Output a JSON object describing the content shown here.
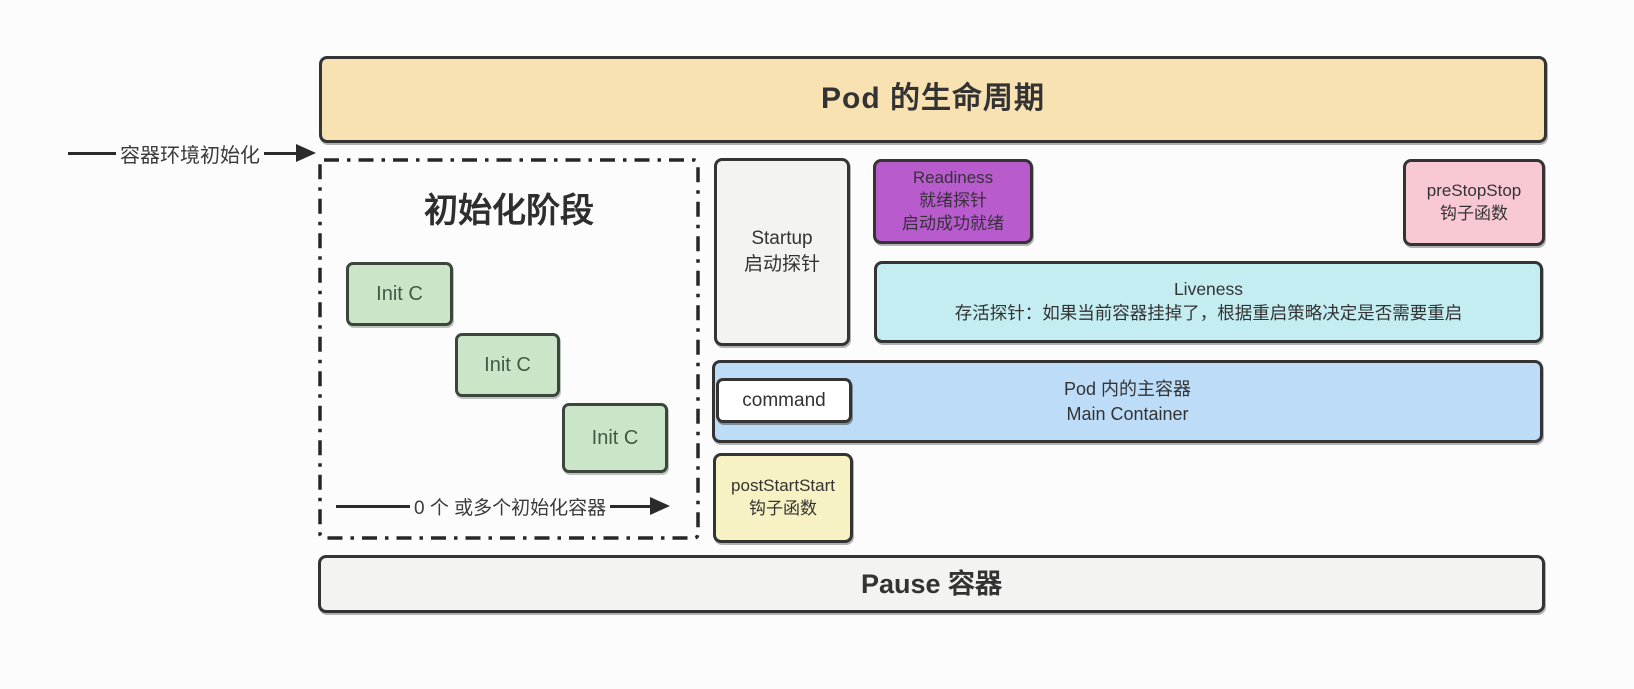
{
  "diagram": {
    "title": "Pod 的生命周期",
    "env_init_arrow_label": "容器环境初始化",
    "init_phase": {
      "title": "初始化阶段",
      "init_containers": [
        {
          "label": "Init C"
        },
        {
          "label": "Init C"
        },
        {
          "label": "Init C"
        }
      ],
      "arrow_label": "0 个 或多个初始化容器"
    },
    "startup_probe": {
      "line1": "Startup",
      "line2": "启动探针"
    },
    "readiness_probe": {
      "line1": "Readiness",
      "line2": "就绪探针",
      "line3": "启动成功就绪"
    },
    "pre_stop_hook": {
      "line1": "preStopStop",
      "line2": "钩子函数"
    },
    "liveness_probe": {
      "line1": "Liveness",
      "line2": "存活探针：如果当前容器挂掉了，根据重启策略决定是否需要重启"
    },
    "command_label": "command",
    "main_container": {
      "line1": "Pod 内的主容器",
      "line2": "Main Container"
    },
    "post_start_hook": {
      "line1": "postStartStart",
      "line2": "钩子函数"
    },
    "pause_container": "Pause 容器"
  },
  "colors": {
    "banner_fill": "#f8e2b2",
    "gray_fill": "#f3f3f1",
    "purple_fill": "#b75bcd",
    "pink_fill": "#f8c9d3",
    "cyan_fill": "#c3edf1",
    "blue_fill": "#bddcf8",
    "yellow_fill": "#f6f2c3",
    "green_fill": "#cbe5c9",
    "border_dark": "#343434",
    "text_dark": "#333333"
  }
}
